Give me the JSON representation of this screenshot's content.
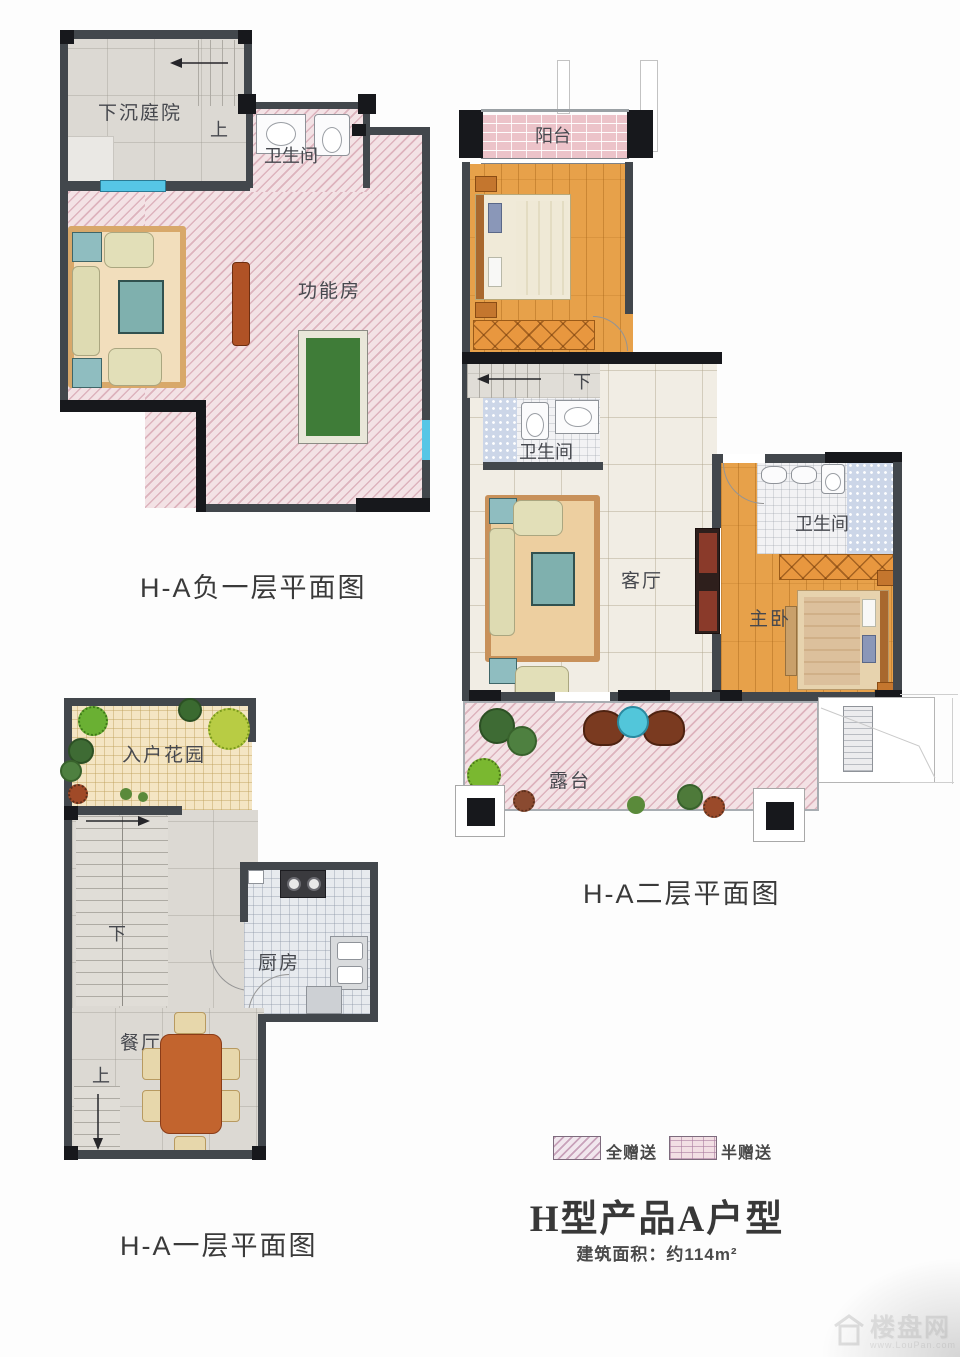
{
  "plans": {
    "basement": {
      "caption": "H-A负一层平面图",
      "labels": {
        "courtyard": "下沉庭院",
        "up": "上",
        "bathroom": "卫生间",
        "function_room": "功能房"
      }
    },
    "floor2": {
      "caption": "H-A二层平面图",
      "labels": {
        "balcony": "阳台",
        "bedroom": "卧室",
        "down": "下",
        "bathroom1": "卫生间",
        "living": "客厅",
        "bathroom2": "卫生间",
        "master": "主卧",
        "terrace": "露台"
      }
    },
    "floor1": {
      "caption": "H-A一层平面图",
      "labels": {
        "garden": "入户花园",
        "down": "下",
        "kitchen": "厨房",
        "dining": "餐厅",
        "up": "上"
      }
    }
  },
  "legend": {
    "full_gift": "全赠送",
    "half_gift": "半赠送"
  },
  "title": "H型产品A户型",
  "area": "建筑面积：约114m²",
  "watermark": {
    "site": "楼盘网",
    "url": "www.LouPan.com"
  },
  "colors": {
    "gift_hatch": "#e8c6cd",
    "brick": "#ecc3c9",
    "wood_floor": "#e7a14a",
    "wall": "#42474c",
    "pool_table": "#3f7c38",
    "window_glass": "#56c6e6"
  }
}
